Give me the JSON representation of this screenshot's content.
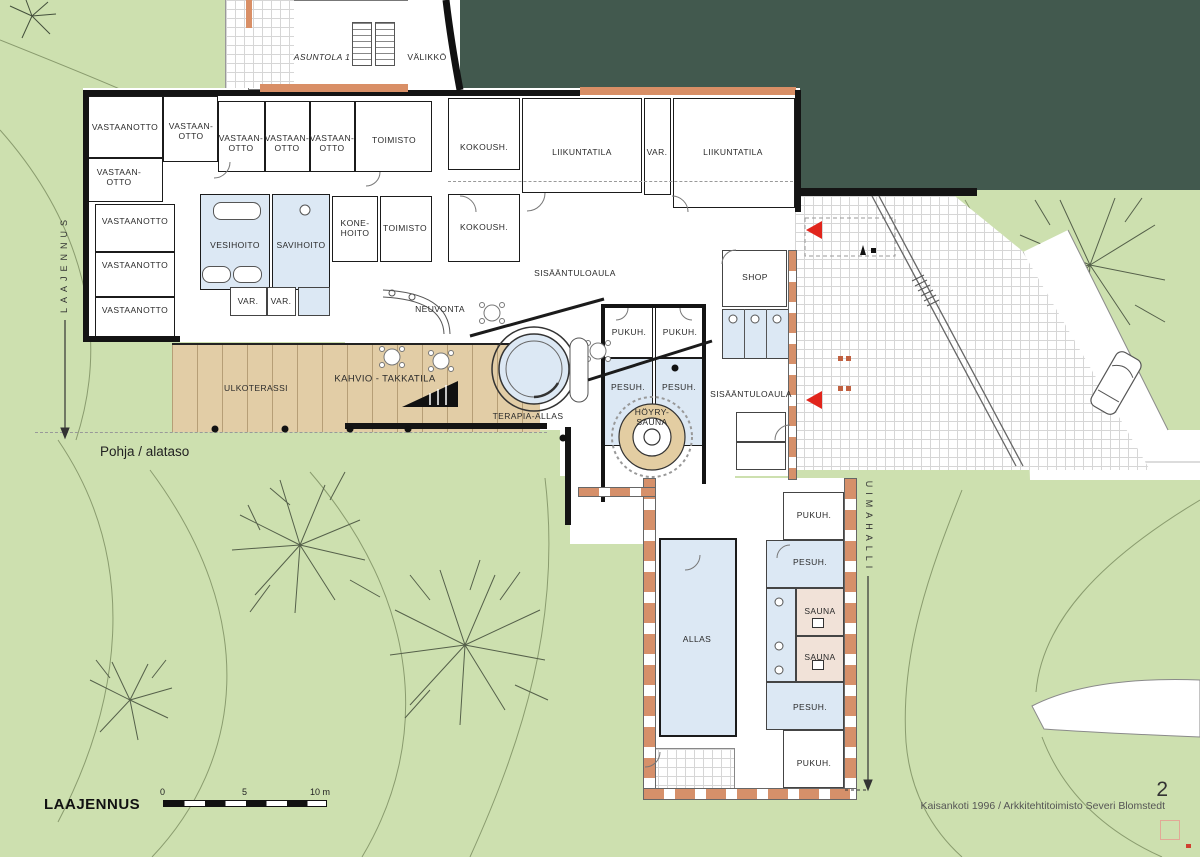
{
  "plan": {
    "drawing_title": "Pohja / alataso",
    "sheet_number": "2",
    "credit": "Kaisankoti 1996 / Arkkitehtitoimisto Severi Blomstedt",
    "expansion_side_label": "LAAJENNUS",
    "expansion_title": "LAAJENNUS",
    "pool_hall_label": "UIMAHALLI",
    "scale_bar": {
      "t0": "0",
      "t5": "5",
      "t10": "10 m"
    }
  },
  "rooms": {
    "vastaanotto": "VASTAANOTTO",
    "vastaanotto_h": "VASTAAN-OTTO",
    "toimisto": "TOIMISTO",
    "kokoush": "KOKOUSH.",
    "liikuntatila": "LIIKUNTATILA",
    "var": "VAR.",
    "asuntola": "ASUNTOLA 1",
    "valikko": "VÄLIKKÖ",
    "vesihoito": "VESIHOITO",
    "savihoito": "SAVIHOITO",
    "konehoito": "KONE-HOITO",
    "neuvonta": "NEUVONTA",
    "sisaantuloaula": "SISÄÄNTULOAULA",
    "shop": "SHOP",
    "pukuh": "PUKUH.",
    "pesuh": "PESUH.",
    "hoyrysauna": "HÖYRY-SAUNA",
    "terapia_allas": "TERAPIA-ALLAS",
    "kahvio": "KAHVIO - TAKKATILA",
    "ulkoterassi": "ULKOTERASSI",
    "allas": "ALLAS",
    "sauna": "SAUNA"
  },
  "colors": {
    "site_green": "#cde0af",
    "forest_green": "#42594e",
    "terracotta": "#d6906a",
    "wet_room_blue": "#dce8f4",
    "sauna_pink": "#f1e2d8",
    "deck_tan": "#e2cda6",
    "wall_black": "#141414",
    "entrance_arrow_red": "#e1251c"
  }
}
